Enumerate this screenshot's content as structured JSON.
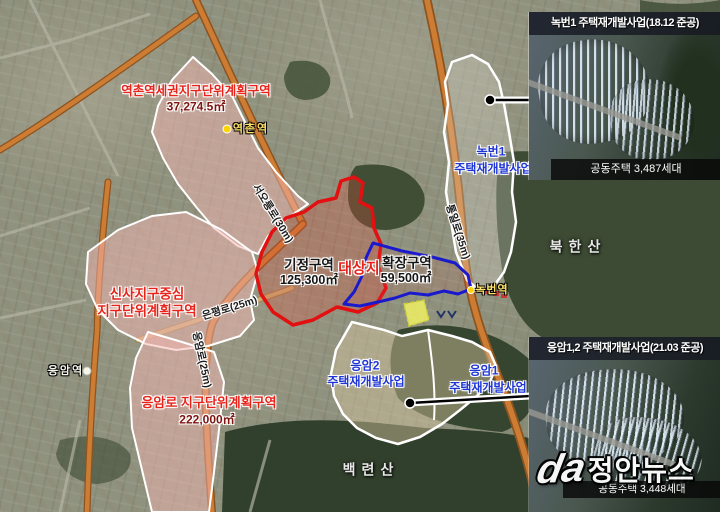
{
  "map": {
    "districts": [
      {
        "id": "yeokchon",
        "title": "역촌역세권지구단위계획구역",
        "area": "37,274.5㎡"
      },
      {
        "id": "sinsa",
        "line1": "신사지구중심",
        "line2": "지구단위계획구역"
      },
      {
        "id": "eumamro",
        "title": "응암로 지구단위계획구역",
        "area": "222,000㎡"
      }
    ],
    "zones": [
      {
        "id": "gijeong",
        "label": "기정구역",
        "area": "125,300㎡"
      },
      {
        "id": "daesangji",
        "label": "대상지"
      },
      {
        "id": "hwakjang",
        "label": "확장구역",
        "area": "59,500㎡"
      }
    ],
    "projects": [
      {
        "id": "nokbeon1",
        "line1": "녹번1",
        "line2": "주택재개발사업"
      },
      {
        "id": "eumam2",
        "line1": "응암2",
        "line2": "주택재개발사업"
      },
      {
        "id": "eumam1",
        "line1": "응암1",
        "line2": "주택재개발사업"
      }
    ],
    "stations": [
      {
        "id": "yeokchon-station",
        "label": "역촌역"
      },
      {
        "id": "nokbeon-station",
        "label": "녹번역"
      },
      {
        "id": "eumam-station",
        "label": "응암역"
      }
    ],
    "roads": [
      {
        "id": "seooreung",
        "label": "서오릉로(30m)"
      },
      {
        "id": "tongil",
        "label": "통일로(35m)"
      },
      {
        "id": "eunpyeong",
        "label": "은평로(25m)"
      },
      {
        "id": "eumam-ro",
        "label": "응암로(25m)"
      }
    ],
    "mountains": [
      {
        "id": "bukhansan",
        "label": "북한산"
      },
      {
        "id": "baekryeonsan",
        "label": "백련산"
      }
    ]
  },
  "panels": {
    "top": {
      "title": "녹번1 주택재개발사업(18.12 준공)",
      "caption": "공동주택 3,487세대"
    },
    "bottom": {
      "title": "응암1,2 주택재개발사업(21.03 준공)",
      "caption": "공동주택 3,448세대"
    }
  },
  "watermark": {
    "logo_text": "da",
    "text": "정안뉴스"
  },
  "colors": {
    "existing_zone_boundary": "#e21010",
    "expansion_zone_boundary": "#1a1acc",
    "district_fill": "#f3baba",
    "station_marker": "#ffd400",
    "project_label": "#1e35d6"
  }
}
